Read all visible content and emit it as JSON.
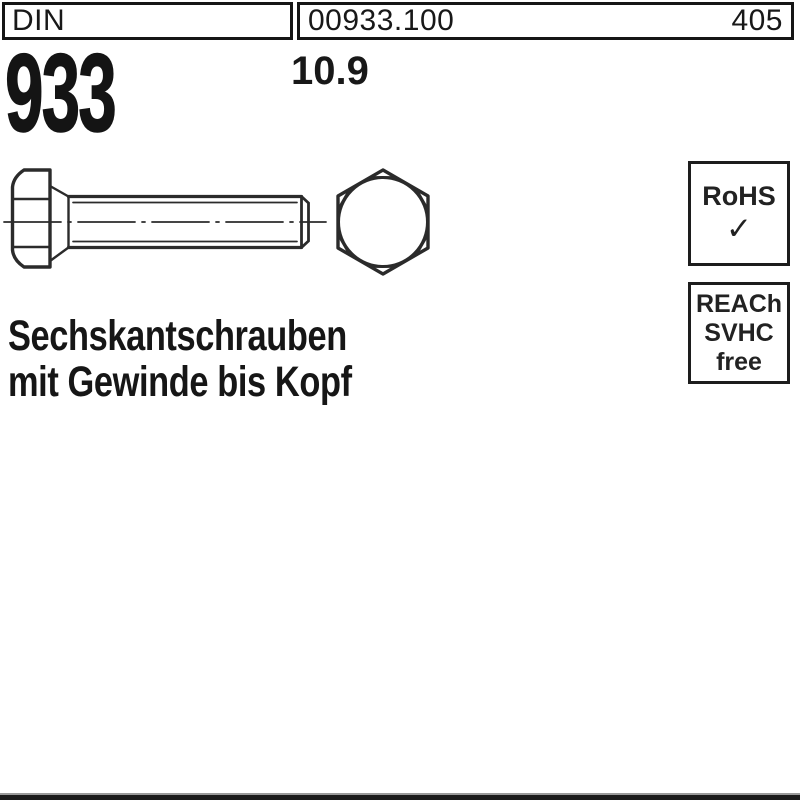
{
  "header": {
    "din_label": "DIN",
    "article_number": "00933.100",
    "page_number": "405"
  },
  "product": {
    "din_number": "933",
    "strength_class": "10.9",
    "title_line1": "Sechskantschrauben",
    "title_line2": "mit Gewinde bis Kopf"
  },
  "badges": {
    "rohs": {
      "label": "RoHS",
      "check": "✓"
    },
    "reach": {
      "line1": "REACh",
      "line2": "SVHC",
      "line3": "free"
    }
  },
  "drawing": {
    "description": "hex-bolt-side-and-front-view"
  },
  "colors": {
    "background": "#ffffff",
    "line": "#2b2b2b",
    "text": "#111111",
    "bottom_bar": "#1a1a1a"
  }
}
